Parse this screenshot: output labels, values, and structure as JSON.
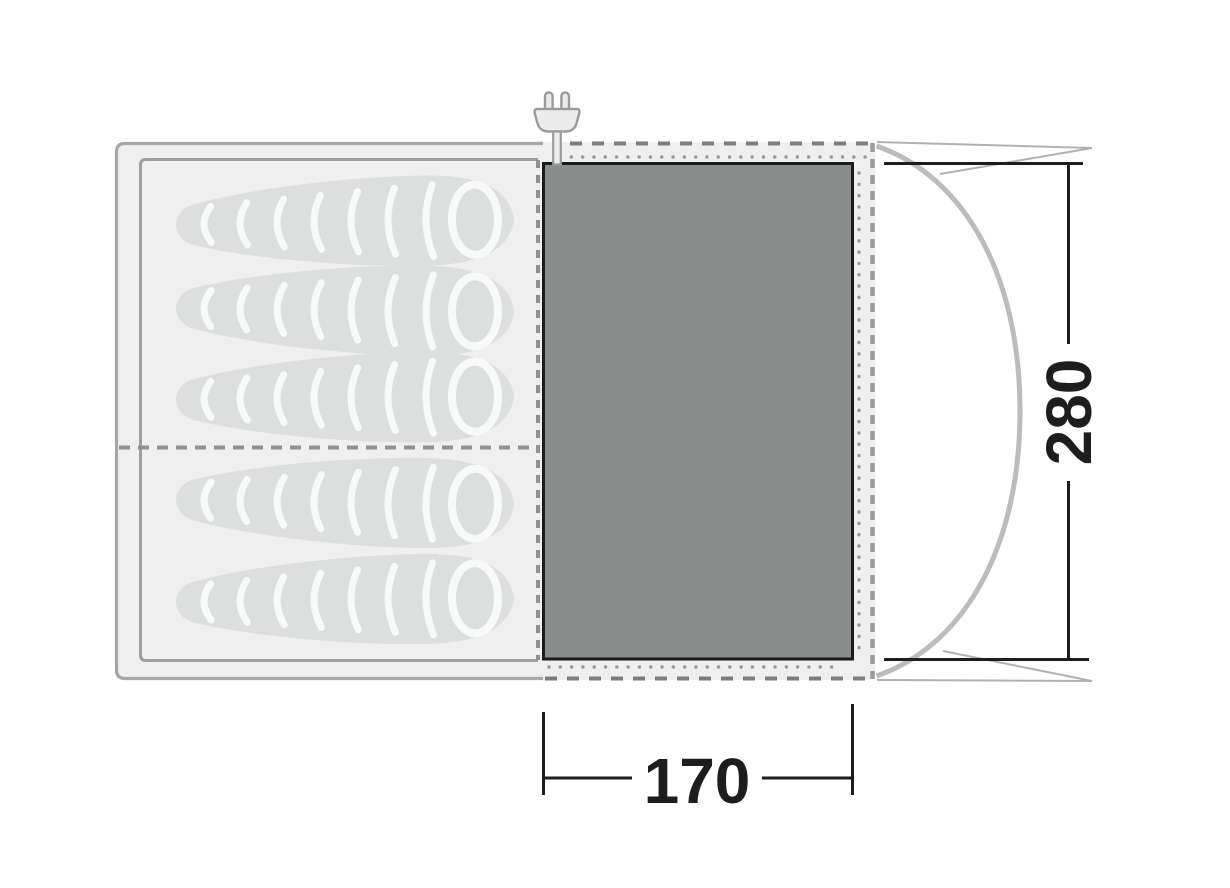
{
  "floorplan": {
    "dimension_labels": {
      "floor_width": "170",
      "floor_depth": "280"
    },
    "sleeping_bag_count": 5,
    "compartments": 2
  },
  "icons": {
    "power": "power-plug-icon"
  },
  "colors": {
    "background": "#ffffff",
    "tent_fill": "#efefef",
    "tent_border": "#a8a8a8",
    "tent_edge_dash_dark": "#7e7e7e",
    "tent_edge_dash_light": "#9c9c9c",
    "compartment_border": "#9e9e9e",
    "divider_dash": "#919191",
    "floor_fill": "#898d8c",
    "floor_border": "#1b1b1b",
    "bag_fill": "#dcdfde",
    "bag_stripe": "#f8f9f9",
    "stitch_dot": "#9a9a9a",
    "porch_line": "#bcbcbc",
    "guy_line": "#b2b2b2",
    "dimension_ink": "#1d1d1d",
    "plug_fill": "#ececec",
    "plug_outline": "#9b9b9b"
  }
}
